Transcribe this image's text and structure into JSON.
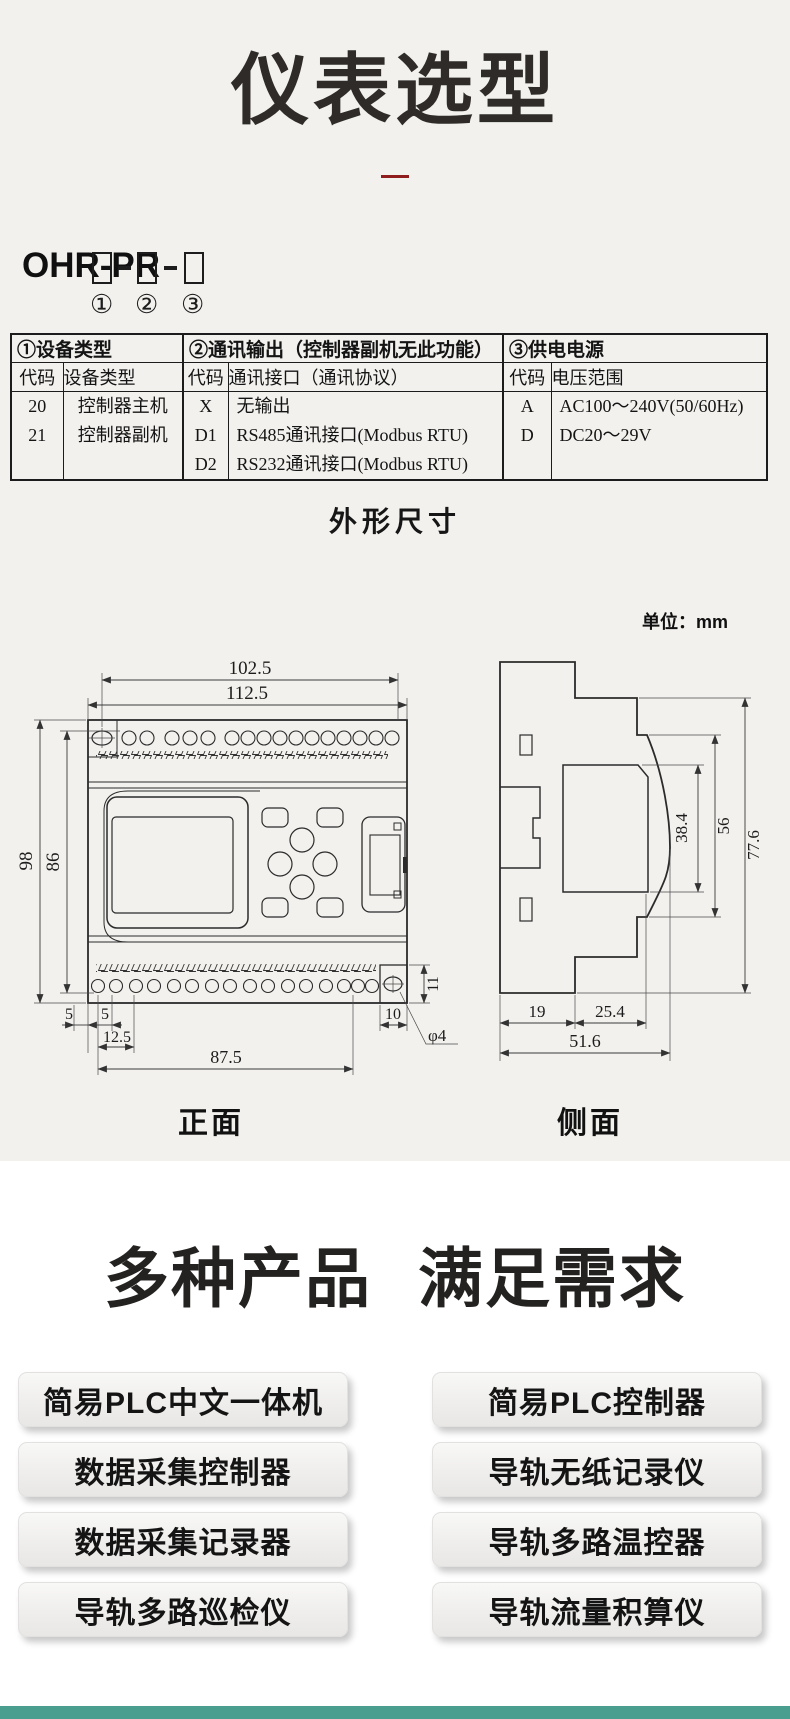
{
  "page": {
    "title": "仪表选型"
  },
  "colors": {
    "title_accent": "#8f1d1d",
    "footer_bar": "#4a9e8f",
    "background_top": "#f2f1ee",
    "background_bottom": "#ffffff"
  },
  "model_code": {
    "prefix": "OHR-PR",
    "slots": [
      "①",
      "②",
      "③"
    ]
  },
  "selection_table": {
    "groups": [
      {
        "title": "①设备类型",
        "cols": [
          "代码",
          "设备类型"
        ],
        "cells": [
          [
            "20",
            "21",
            ""
          ],
          [
            "控制器主机",
            "控制器副机",
            ""
          ]
        ]
      },
      {
        "title": "②通讯输出（控制器副机无此功能）",
        "cols": [
          "代码",
          "通讯接口（通讯协议）"
        ],
        "cells": [
          [
            "X",
            "D1",
            "D2"
          ],
          [
            "无输出",
            "RS485通讯接口(Modbus RTU)",
            "RS232通讯接口(Modbus RTU)"
          ]
        ]
      },
      {
        "title": "③供电电源",
        "cols": [
          "代码",
          "电压范围"
        ],
        "cells": [
          [
            "A",
            "D",
            ""
          ],
          [
            "AC100～240V(50/60Hz)",
            "DC20～29V",
            ""
          ]
        ]
      }
    ]
  },
  "dimensions": {
    "section_title": "外形尺寸",
    "unit_label": "单位：mm",
    "front": {
      "view_label": "正面",
      "w_top": "102.5",
      "w_full": "112.5",
      "h_full": "98",
      "h_inner": "86",
      "offset_left": "5",
      "offset_terminal": "5",
      "pitch_first": "12.5",
      "terminal_span": "87.5",
      "offset_right": "10",
      "hole_offset": "11",
      "hole_dia": "φ4"
    },
    "side": {
      "view_label": "侧面",
      "display_depth": "38.4",
      "body_depth": "56",
      "total_depth": "77.6",
      "base_left": "19",
      "base_right": "25.4",
      "base_total": "51.6"
    }
  },
  "products": {
    "heading": [
      "多种产品",
      "满足需求"
    ],
    "left": [
      "简易PLC中文一体机",
      "数据采集控制器",
      "数据采集记录器",
      "导轨多路巡检仪"
    ],
    "right": [
      "简易PLC控制器",
      "导轨无纸记录仪",
      "导轨多路温控器",
      "导轨流量积算仪"
    ]
  }
}
